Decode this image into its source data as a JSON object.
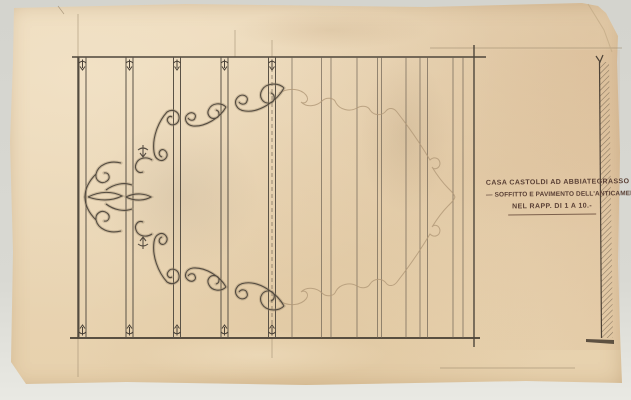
{
  "title_block": {
    "line1": "CASA CASTOLDI AD ABBIATEGRASSO",
    "line2_dash": "—",
    "line2": "SOFFITTO E PAVIMENTO DELL'ANTICAMERA",
    "line3": "NEL RAPP. DI 1 A 10.-"
  },
  "drawing": {
    "plan_rect": {
      "x": 78,
      "y": 57,
      "width": 396,
      "height": 281
    },
    "beams_x": [
      79,
      126,
      173.5,
      221,
      268.5
    ],
    "beam_width": 7,
    "dashed_beam_index": 4,
    "board_lines_x": [
      292,
      321.5,
      331,
      357,
      377.5,
      381.5,
      406,
      420,
      427.5,
      453,
      463
    ],
    "construction_lines": [
      {
        "x1": 78,
        "y1": 14,
        "x2": 78,
        "y2": 57
      },
      {
        "x1": 78,
        "y1": 338,
        "x2": 78,
        "y2": 377
      },
      {
        "x1": 235,
        "y1": 30,
        "x2": 235,
        "y2": 57
      },
      {
        "x1": 272,
        "y1": 40,
        "x2": 272,
        "y2": 57
      },
      {
        "x1": 272,
        "y1": 338,
        "x2": 272,
        "y2": 358
      },
      {
        "x1": 430,
        "y1": 48,
        "x2": 622,
        "y2": 48
      },
      {
        "x1": 440,
        "y1": 368,
        "x2": 575,
        "y2": 368
      },
      {
        "x1": 58,
        "y1": 6,
        "x2": 64,
        "y2": 14
      }
    ],
    "colors": {
      "background": "#d7d7d1",
      "paper": "#e9d6b6",
      "ink_dark": "#4a4238",
      "ink_medium": "#6a5f50",
      "ink_wash": "#9b8a6f",
      "ink_faint": "#b09777",
      "text_ink": "#5a4035"
    }
  }
}
